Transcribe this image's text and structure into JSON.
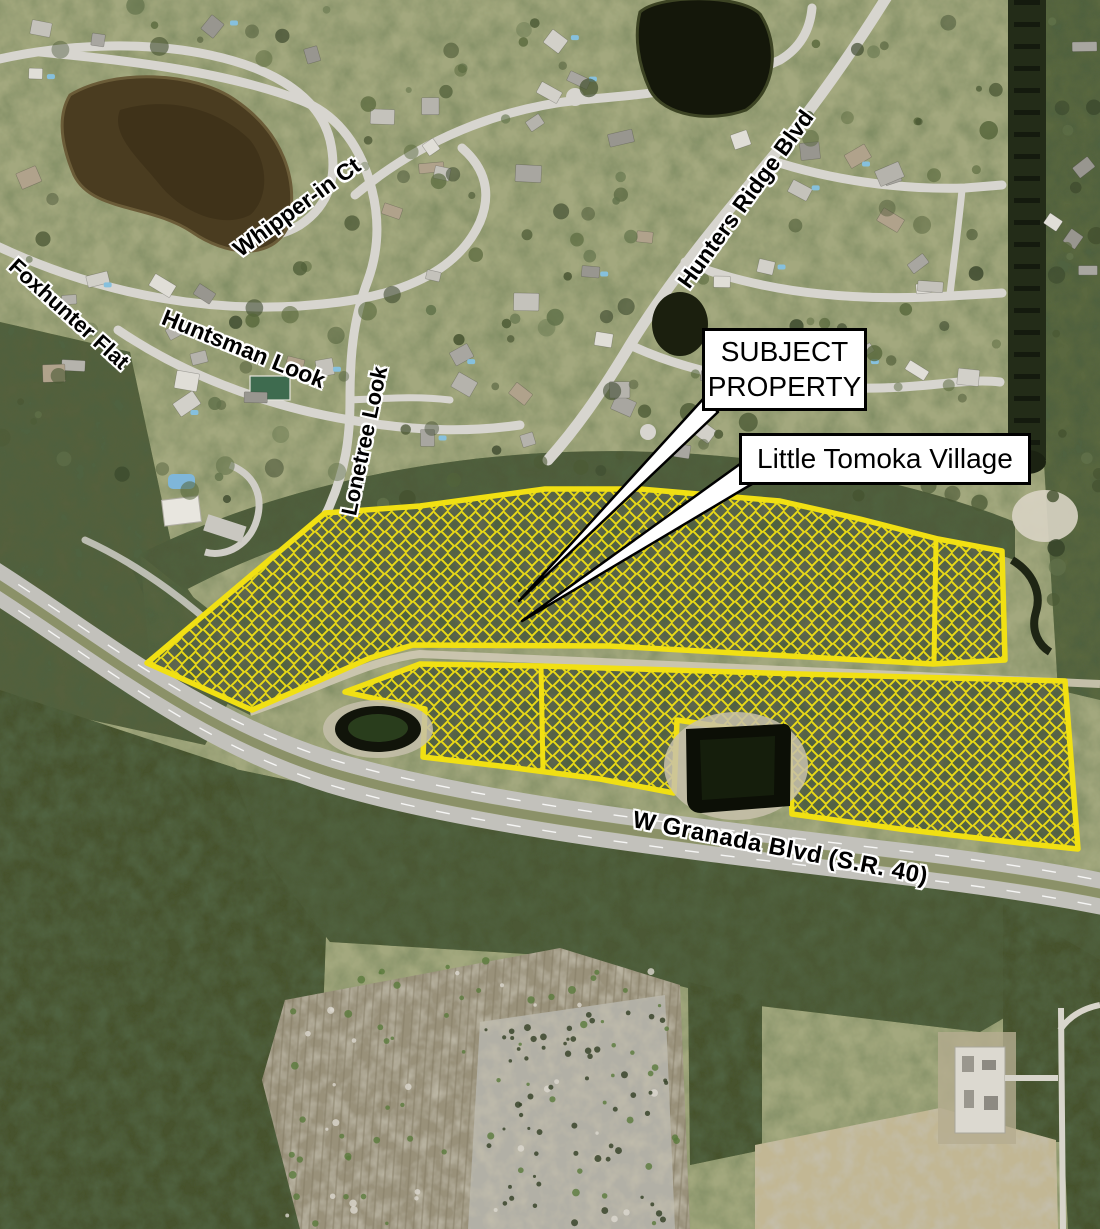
{
  "map": {
    "annotations": {
      "subject_property": {
        "line1": "SUBJECT",
        "line2": "PROPERTY"
      },
      "village": "Little Tomoka Village"
    },
    "street_labels": [
      {
        "id": "foxhunter-flat",
        "text": "Foxhunter Flat"
      },
      {
        "id": "huntsman-look",
        "text": "Huntsman Look"
      },
      {
        "id": "whipper-in-ct",
        "text": "Whipper-in Ct"
      },
      {
        "id": "lonetree-look",
        "text": "Lonetree Look"
      },
      {
        "id": "hunters-ridge-blvd",
        "text": "Hunters Ridge Blvd"
      },
      {
        "id": "granada-blvd",
        "text": "W Granada Blvd (S.R. 40)"
      }
    ],
    "colors": {
      "parcel_outline": "#f1e013",
      "parcel_hatch": "#f1e013",
      "callout_background": "#ffffff",
      "callout_border": "#000000",
      "callout_text": "#000000",
      "street_label_text": "#000000",
      "street_label_halo": "#ffffff"
    }
  }
}
